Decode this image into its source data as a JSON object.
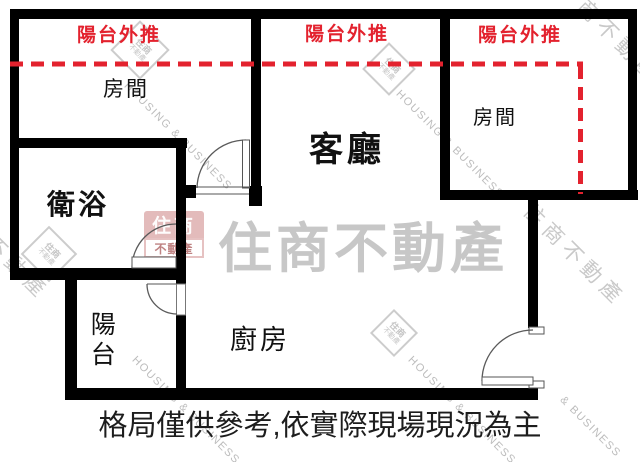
{
  "floorplan": {
    "rooms": {
      "bedroom": "房間",
      "living_room": "客廳",
      "bathroom": "衛浴",
      "balcony": "陽台",
      "kitchen": "廚房"
    },
    "annotations": {
      "balcony_pushout": "陽台外推"
    },
    "disclaimer": "格局僅供參考,依實際現場現況為主",
    "colors": {
      "wall": "#000000",
      "annotation_red": "#e3222e",
      "watermark_gray": "#c7c7c7",
      "door_line_gray": "#5a5a5a"
    },
    "watermark": {
      "brand_cjk": "住商不動產",
      "brand_en": "HOUSING & BUSINESS",
      "brand_en_fragment": "& BUSINESS",
      "brand_fragment": "商不動產",
      "brand_fragment_short": "不動產",
      "logo_top": "住商",
      "logo_bottom": "不動產"
    }
  }
}
